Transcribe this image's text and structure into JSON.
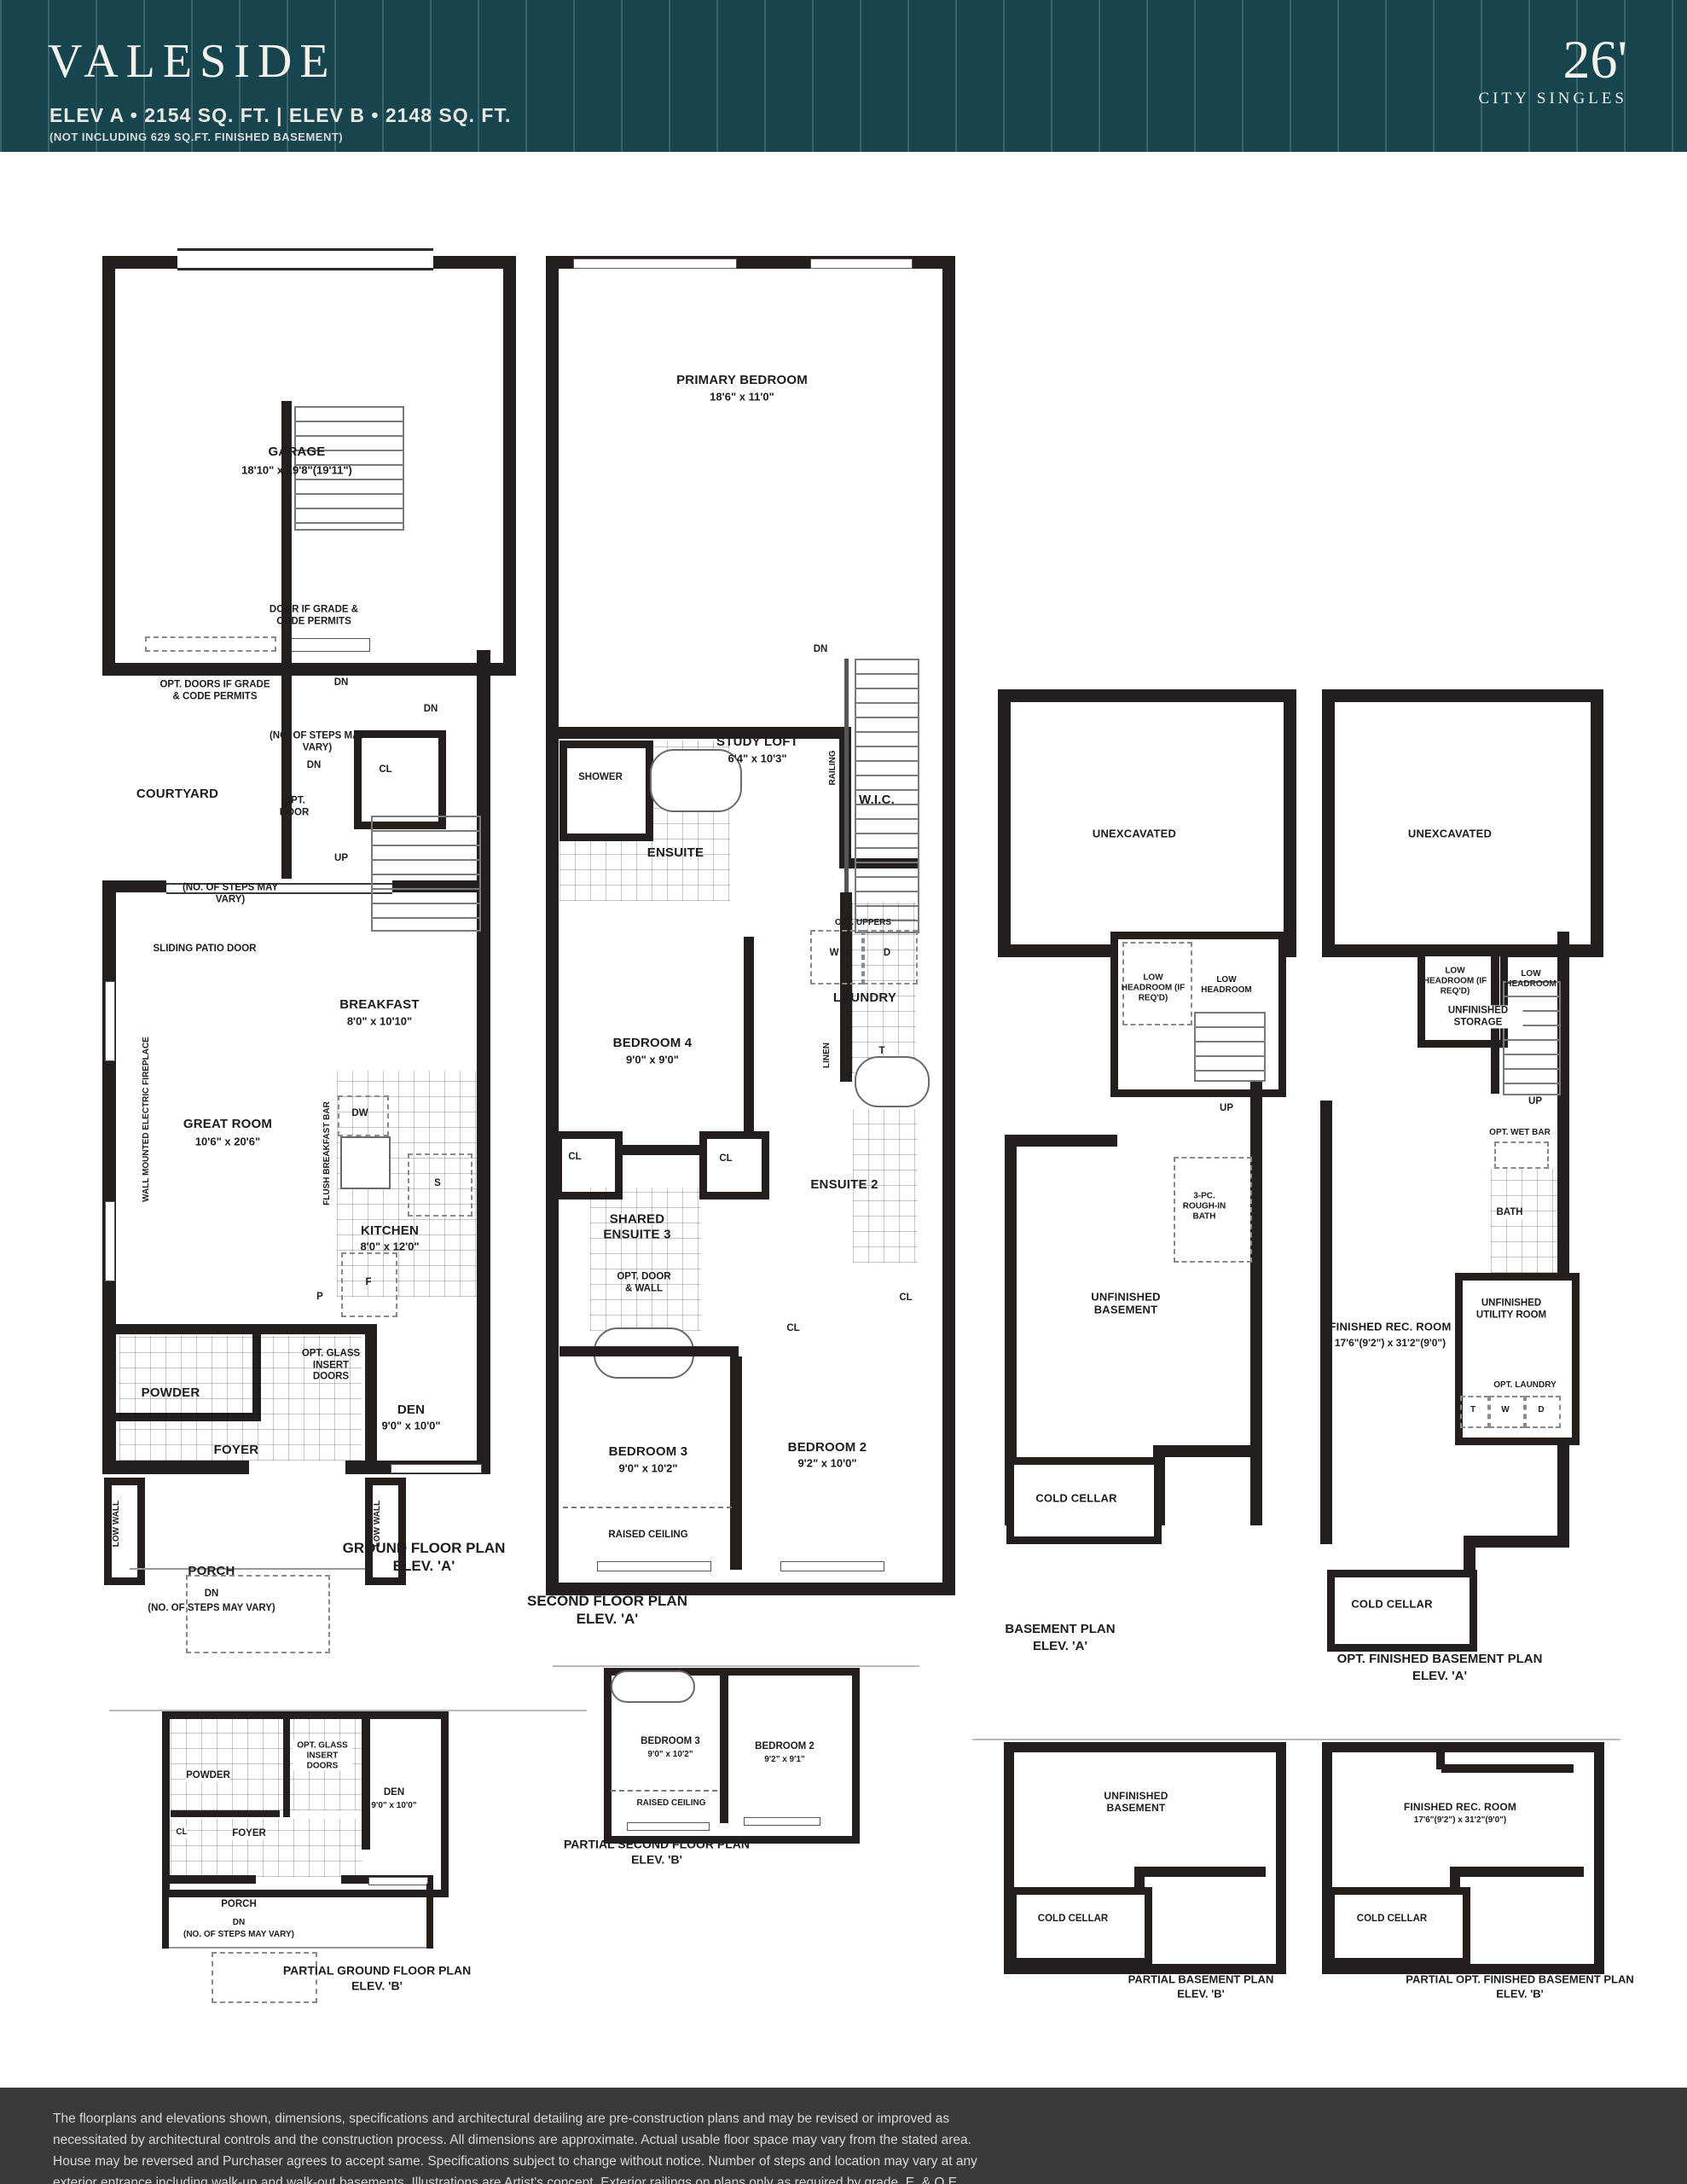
{
  "header": {
    "title": "VALESIDE",
    "specs": "ELEV A  • 2154 SQ. FT.  |  ELEV B  • 2148 SQ. FT.",
    "note": "(NOT INCLUDING 629 SQ.FT. FINISHED BASEMENT)",
    "frontage": "26'",
    "series": "CITY SINGLES"
  },
  "colors": {
    "header_teal": "#16454F",
    "footer_gray": "#3A3A3A",
    "wall_black": "#241F1C"
  },
  "footer": {
    "disclaimer": "The floorplans and elevations shown, dimensions, specifications and architectural detailing are pre-construction plans and may be revised or improved as necessitated by architectural controls and the construction process. All dimensions are approximate. Actual usable floor space may vary from the stated area. House may be reversed and Purchaser agrees to accept same. Specifications subject to change without notice. Number of steps and location may vary at any exterior entrance including walk-up and walk-out basements. Illustrations are Artist's concept. Exterior railings on plans only as required by grade. E. & O.E.  03/24",
    "code": "ARL.26-1"
  },
  "plans": {
    "ground": {
      "title": "GROUND FLOOR PLAN",
      "elev": "ELEV. 'A'",
      "labels": {
        "garage": "GARAGE",
        "garage_dim": "18'10\" x 19'8\"(19'11\")",
        "door_note": "DOOR IF GRADE & CODE PERMITS",
        "opt_doors_note": "OPT. DOORS IF GRADE & CODE PERMITS",
        "dn1": "DN",
        "dn2": "DN",
        "dn3": "DN",
        "steps_note1": "(NO. OF STEPS MAY VARY)",
        "cl1": "CL",
        "courtyard": "COURTYARD",
        "opt_door": "OPT. DOOR",
        "up": "UP",
        "steps_note2": "(NO. OF STEPS MAY VARY)",
        "sliding_door": "SLIDING PATIO DOOR",
        "breakfast": "BREAKFAST",
        "breakfast_dim": "8'0\" x 10'10\"",
        "great_room": "GREAT ROOM",
        "great_room_dim": "10'6\" x 20'6\"",
        "fireplace": "WALL MOUNTED ELECTRIC FIREPLACE",
        "flush_bar": "FLUSH BREAKFAST BAR",
        "dw": "DW",
        "s": "S",
        "kitchen": "KITCHEN",
        "kitchen_dim": "8'0\" x 12'0\"",
        "f": "F",
        "p": "P",
        "opt_glass": "OPT. GLASS INSERT DOORS",
        "powder": "POWDER",
        "den": "DEN",
        "den_dim": "9'0\" x 10'0\"",
        "foyer": "FOYER",
        "cl2": "CL",
        "porch": "PORCH",
        "dn_porch": "DN",
        "steps_note3": "(NO. OF STEPS MAY VARY)",
        "low_wall_left": "LOW WALL",
        "low_wall_right": "LOW WALL"
      }
    },
    "second": {
      "title": "SECOND FLOOR PLAN",
      "elev": "ELEV. 'A'",
      "labels": {
        "primary": "PRIMARY BEDROOM",
        "primary_dim": "18'6\" x 11'0\"",
        "shower": "SHOWER",
        "ensuite": "ENSUITE",
        "wic": "W.I.C.",
        "dn": "DN",
        "study": "STUDY LOFT",
        "study_dim": "6'4\" x 10'3\"",
        "railing": "RAILING",
        "opt_uppers": "OPT. UPPERS",
        "w": "W",
        "d": "D",
        "laundry": "LAUNDRY",
        "linen": "LINEN",
        "t": "T",
        "bedroom4": "BEDROOM 4",
        "bedroom4_dim": "9'0\" x 9'0\"",
        "cl1": "CL",
        "cl2": "CL",
        "cl3": "CL",
        "cl4": "CL",
        "shared_ensuite": "SHARED ENSUITE 3",
        "opt_door_wall": "OPT. DOOR & WALL",
        "ensuite2": "ENSUITE 2",
        "bedroom3": "BEDROOM 3",
        "bedroom3_dim": "9'0\" x 10'2\"",
        "bedroom2": "BEDROOM 2",
        "bedroom2_dim": "9'2\" x 10'0\"",
        "raised": "RAISED CEILING"
      }
    },
    "basementA": {
      "title": "BASEMENT PLAN",
      "elev": "ELEV. 'A'",
      "labels": {
        "unexcavated": "UNEXCAVATED",
        "low_headroom_req": "LOW HEADROOM (IF REQ'D)",
        "low_headroom": "LOW HEADROOM",
        "up": "UP",
        "rough_in": "3-PC. ROUGH-IN BATH",
        "unfinished": "UNFINISHED BASEMENT",
        "cold_cellar": "COLD CELLAR"
      }
    },
    "optBasementA": {
      "title": "OPT. FINISHED BASEMENT PLAN",
      "elev": "ELEV. 'A'",
      "labels": {
        "unexcavated": "UNEXCAVATED",
        "low_headroom_req": "LOW HEADROOM (IF REQ'D)",
        "low_headroom": "LOW HEADROOM",
        "storage": "UNFINISHED STORAGE",
        "up": "UP",
        "wet_bar": "OPT. WET BAR",
        "bath": "BATH",
        "utility": "UNFINISHED UTILITY ROOM",
        "rec_room": "FINISHED REC. ROOM",
        "rec_room_dim": "17'6\"(9'2\") x 31'2\"(9'0\")",
        "opt_laundry": "OPT. LAUNDRY",
        "t": "T",
        "w": "W",
        "d": "D",
        "cold_cellar": "COLD CELLAR"
      }
    },
    "partialGround": {
      "title": "PARTIAL GROUND FLOOR PLAN",
      "elev": "ELEV. 'B'",
      "labels": {
        "powder": "POWDER",
        "opt_glass": "OPT. GLASS INSERT DOORS",
        "den": "DEN",
        "den_dim": "9'0\" x 10'0\"",
        "cl": "CL",
        "foyer": "FOYER",
        "porch": "PORCH",
        "dn": "DN",
        "steps_note": "(NO. OF STEPS MAY VARY)"
      }
    },
    "partialSecond": {
      "title": "PARTIAL SECOND FLOOR PLAN",
      "elev": "ELEV. 'B'",
      "labels": {
        "bedroom3": "BEDROOM 3",
        "bedroom3_dim": "9'0\" x 10'2\"",
        "bedroom2": "BEDROOM 2",
        "bedroom2_dim": "9'2\" x 9'1\"",
        "raised": "RAISED CEILING"
      }
    },
    "partialBasement": {
      "title": "PARTIAL BASEMENT PLAN",
      "elev": "ELEV. 'B'",
      "labels": {
        "unfinished": "UNFINISHED BASEMENT",
        "cold_cellar": "COLD CELLAR"
      }
    },
    "partialOptBasement": {
      "title": "PARTIAL OPT. FINISHED BASEMENT PLAN",
      "elev": "ELEV. 'B'",
      "labels": {
        "rec_room": "FINISHED REC. ROOM",
        "rec_room_dim": "17'6\"(9'2\") x 31'2\"(9'0\")",
        "cold_cellar": "COLD CELLAR"
      }
    }
  }
}
